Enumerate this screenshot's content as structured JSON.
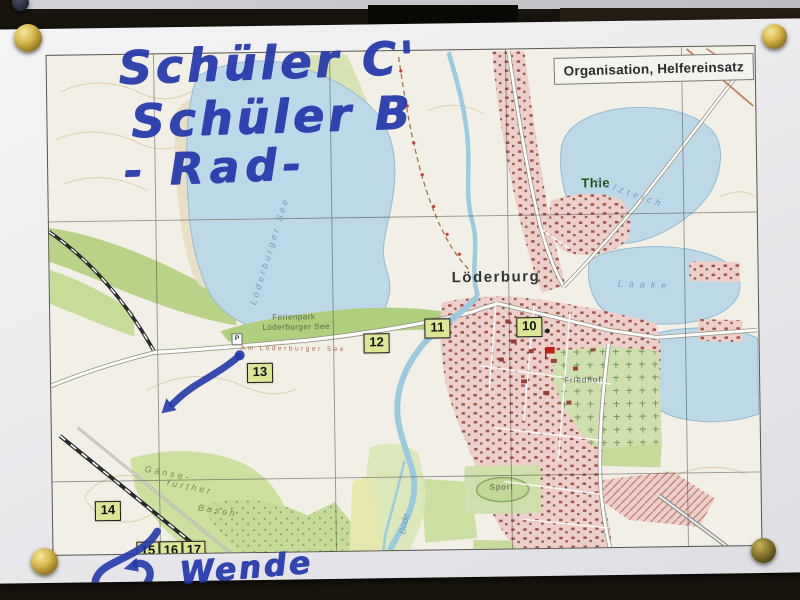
{
  "scene": {
    "description": "Photo of a topographic route map pinned to a dark board",
    "handwriting": {
      "line1": "Schüler C'",
      "line2": "Schüler B",
      "line3": "- Rad-",
      "wende": "Wende",
      "ink_color": "#2438ac"
    },
    "pins": [
      "push-pin-top-left",
      "push-pin-top-right",
      "push-pin-bottom-left",
      "push-pin-bottom-right",
      "push-pin-upper-sheet"
    ]
  },
  "map": {
    "title_box": "Organisation, Helfereinsatz",
    "towns": {
      "loederburg": "Löderburg",
      "thie": "Thie"
    },
    "water_labels": {
      "lake_vertical": "Löderburger See",
      "salzteich": "Salzteich",
      "laake": "Laake",
      "river": "Bode"
    },
    "area_labels": {
      "ferienpark_line1": "Ferienpark",
      "ferienpark_line2": "Löderburger See",
      "street": "Am Löderburger See",
      "friedhof": "Friedhof",
      "sport": "Sport",
      "busch_line1": "Gänse-",
      "busch_line2": "further",
      "busch_line3": "Busch",
      "parking": "P"
    },
    "markers": [
      {
        "label": "10"
      },
      {
        "label": "11"
      },
      {
        "label": "12"
      },
      {
        "label": "13"
      },
      {
        "label": "14"
      },
      {
        "label": "15"
      },
      {
        "label": "16"
      },
      {
        "label": "17"
      }
    ],
    "colors": {
      "water": "#bdd9e8",
      "forest": "#c3d995",
      "urban": "#eecfca",
      "marker_box": "#dce694",
      "road": "#c08060",
      "grid": "#3a3a3a",
      "handwriting_ink": "#2438ac",
      "pin_gold": "#d9b84e"
    }
  }
}
